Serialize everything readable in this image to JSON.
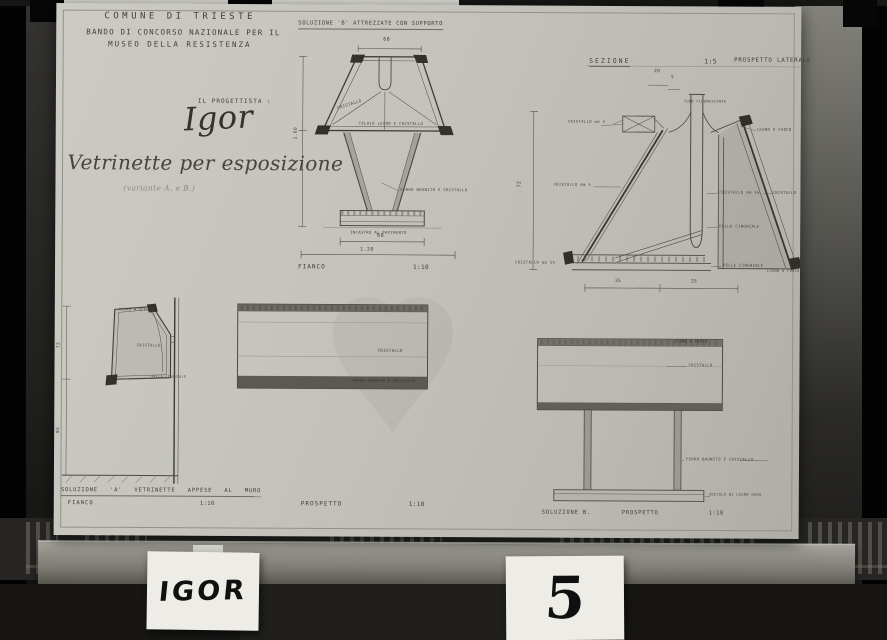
{
  "cards": {
    "name": "IGOR",
    "number": "5"
  },
  "sheet": {
    "header": {
      "line1": "COMUNE DI TRIESTE",
      "line2": "BANDO DI CONCORSO NAZIONALE PER IL",
      "line3": "MUSEO DELLA RESISTENZA"
    },
    "designer_label": "IL PROGETTISTA :",
    "signature": "Igor",
    "title": "Vetrinette per esposizione",
    "subtitle": "(variante A. e B.)",
    "solution_b_side": {
      "heading": "SOLUZIONE 'B' ATTREZZATE CON SUPPORTO",
      "dim_top": "60",
      "dim_base": "60",
      "dim_width": "1.20",
      "dim_height": "1.60",
      "label_glass": "CRISTALLO",
      "label_frame": "TELAIO LEGNO E CRISTALLO",
      "label_stem": "FERRO BRUNITO E CRISTALLO",
      "label_base": "INCASTRO AL PAVIMENTO",
      "caption": "FIANCO",
      "scale": "1:10"
    },
    "section": {
      "heading": "SEZIONE",
      "scale": "1:5",
      "heading_right": "PROSPETTO LATERALE",
      "dim_a": "20",
      "dim_b": "5",
      "dim_height": "72",
      "dim_c": "35",
      "dim_d": "25",
      "label_top": "TUBO FLUORESCENTE",
      "label_glass_1": "CRISTALLO mm 5",
      "label_glass_2": "CRISTALLO mm 5",
      "label_glass_3": "CRISTALLO mm 5½",
      "label_wood_1": "LEGNO A FUOCO",
      "label_glass_4": "CRISTALLO mm 5½",
      "label_glass_5": "CRISTALLO",
      "label_skin_1": "PELLE CINGHIALE",
      "label_skin_2": "PELLE CINGHIALE",
      "label_wood_2": "LEGNO A FUOCO"
    },
    "solution_a_side": {
      "label_top": "VETRO A SCELTA",
      "label_glass": "CRISTALLO",
      "label_skin": "PELLE CINGHIALE",
      "dim_upper": "72",
      "dim_lower": "95",
      "caption": "SOLUZIONE 'A'  VETRINETTE  APPESE  AL MURO",
      "view": "FIANCO",
      "scale": "1:10"
    },
    "front_a": {
      "label_glass": "CRISTALLO",
      "label_frame": "FERRO BRUNITO E CRISTALLO",
      "caption": "PROSPETTO",
      "scale": "1:10"
    },
    "front_b": {
      "label_wood": "LEGNO A FUOCO",
      "label_glass": "CRISTALLO",
      "label_legs": "FERRO BRUNITO E CRISTALLO",
      "label_plinth": "ZOCCOLO DI LEGNO DURO",
      "caption": "SOLUZIONE B.",
      "view": "PROSPETTO",
      "scale": "1:10"
    }
  }
}
